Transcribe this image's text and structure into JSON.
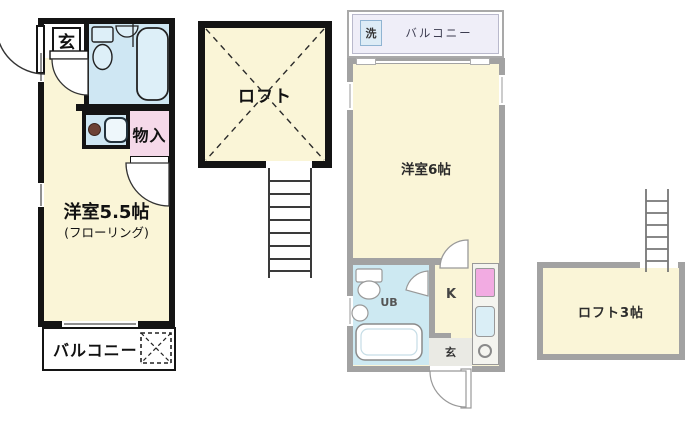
{
  "unit_a": {
    "entrance": "玄",
    "storage": "物入",
    "room": "洋室5.5帖",
    "room_note": "(フローリング)",
    "balcony": "バルコニー"
  },
  "loft_block": {
    "label": "ロフト"
  },
  "unit_b": {
    "washer": "洗",
    "balcony": "バルコニー",
    "room": "洋室6帖",
    "bath": "UB",
    "kitchen": "K",
    "entrance": "玄",
    "loft": "ロフト3帖"
  },
  "colors": {
    "room_fill": "#faf5d7",
    "bath_fill_left": "#cfe7f3",
    "bath_fill_right": "#cde9f2",
    "storage_fill": "#f5d9e9",
    "fridge_pink": "#f2abe2",
    "balcony_fill_right": "#efeef8",
    "wall_black": "#141414",
    "wall_gray": "#a2a2a2"
  }
}
